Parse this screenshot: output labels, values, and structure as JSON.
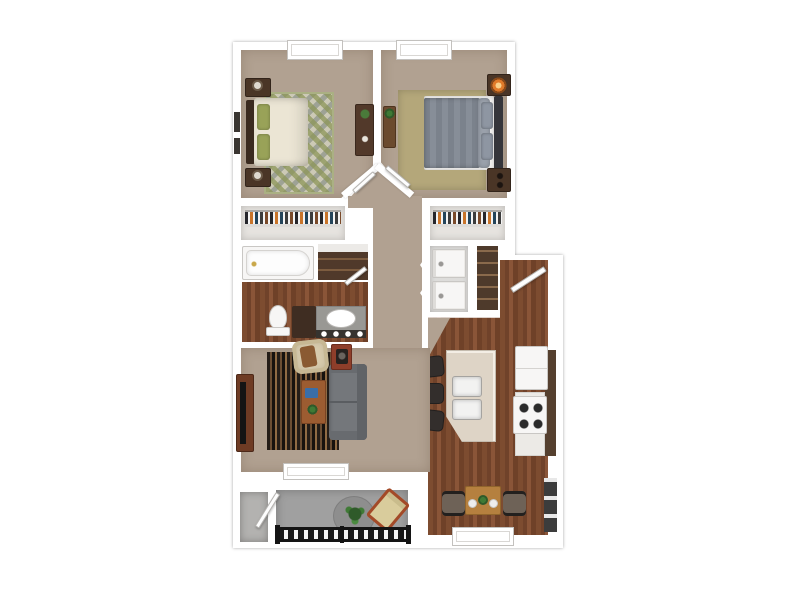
{
  "floor_plan": {
    "title": "2 Bedroom 1 Bathroom Apartment - 3D Top-Down Floor Plan",
    "rooms": {
      "bedroom_1": {
        "name": "Bedroom 1",
        "furniture": [
          "bed with cream duvet and green pillows",
          "dark wood headboard",
          "two nightstands with lamps",
          "desk with plant",
          "green-gray diamond pattern rug",
          "window",
          "wall art"
        ]
      },
      "bedroom_2": {
        "name": "Bedroom 2",
        "furniture": [
          "bed with gray duvet and gray pillows",
          "nightstand with glowing orange lamp",
          "second nightstand",
          "tan area rug",
          "plant stand console",
          "window"
        ]
      },
      "closet_1": {
        "name": "Bedroom 1 Closet",
        "furniture": [
          "hanging clothes"
        ]
      },
      "closet_2": {
        "name": "Bedroom 2 Closet",
        "furniture": [
          "hanging clothes"
        ]
      },
      "bathroom": {
        "name": "Bathroom",
        "furniture": [
          "bathtub",
          "toilet",
          "vanity with oval sink and 4 vanity lights",
          "dark storage cabinet",
          "linen shelves"
        ]
      },
      "laundry_closet": {
        "name": "Laundry Closet",
        "furniture": [
          "washer",
          "dryer",
          "bifold doors"
        ]
      },
      "pantry": {
        "name": "Pantry Shelves"
      },
      "hallway": {
        "name": "Hallway"
      },
      "entry": {
        "name": "Entry",
        "furniture": [
          "front door"
        ]
      },
      "kitchen": {
        "name": "Kitchen",
        "furniture": [
          "island with double sink",
          "3 bar stools",
          "refrigerator",
          "range with 4 burners",
          "dark countertop run"
        ]
      },
      "dining": {
        "name": "Dining Area",
        "furniture": [
          "wood dining table",
          "2 dark chairs",
          "2 plates",
          "centerpiece plant",
          "window",
          "wall niche"
        ]
      },
      "living_room": {
        "name": "Living Room",
        "furniture": [
          "gray sofa",
          "cream armchair with throw",
          "striped area rug",
          "wood coffee table",
          "media console with TV",
          "side table",
          "window to patio"
        ]
      },
      "patio": {
        "name": "Patio",
        "furniture": [
          "round gray rug",
          "potted plant",
          "lounge chair",
          "black metal railing",
          "storage closet"
        ]
      }
    },
    "palette": {
      "wall": "#ffffff",
      "wall_shadow": "#c9c6c2",
      "carpet": "#b1a191",
      "wood_floor": "#7a4a2e",
      "patio_concrete": "#a0a0a0",
      "sofa_gray": "#74777b",
      "armchair_cream": "#d7caac",
      "island_cream": "#ded4c6",
      "countertop_brown": "#55402f",
      "rug_olive": "#9ba56f",
      "duvet_gray": "#7b828c",
      "duvet_cream": "#ebe5d4",
      "furniture_dark_wood": "#4a3526",
      "dining_wood": "#b5803f",
      "lamp_orange": "#e07a2a"
    }
  }
}
